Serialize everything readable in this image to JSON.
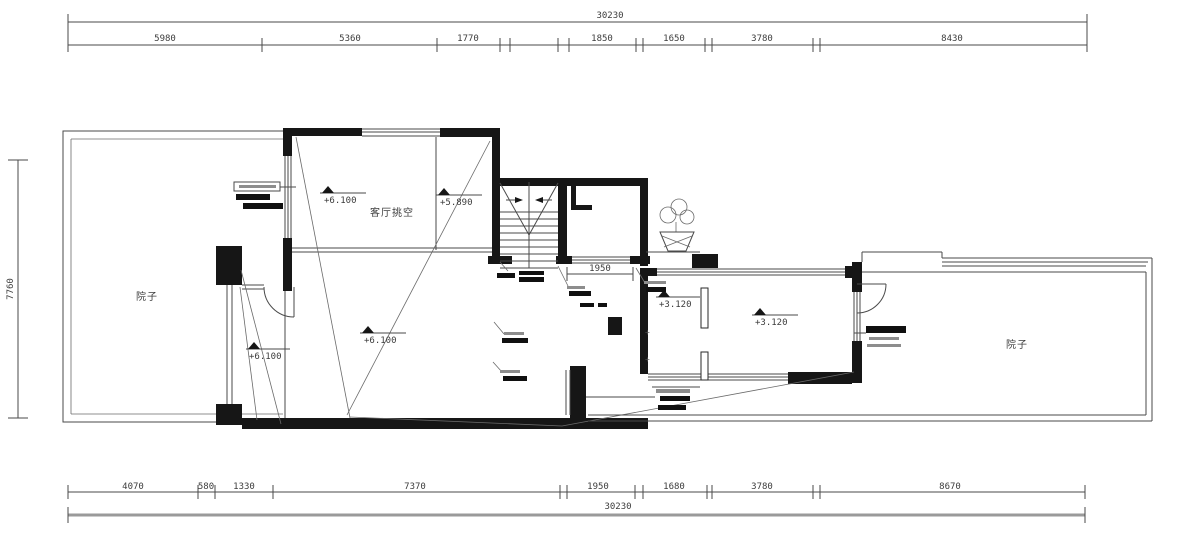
{
  "drawing": {
    "rooms": {
      "living_void": "客厅挑空",
      "courtyard_left": "院子",
      "courtyard_right": "院子"
    },
    "elevations": {
      "e1": "+6.100",
      "e2": "+5.890",
      "e3": "+6.100",
      "e4": "+6.100",
      "e5": "+3.120",
      "e6": "+3.120"
    },
    "dimensions": {
      "overall_top": "30230",
      "overall_bottom": "30230",
      "overall_left": "7760",
      "interior": "1950",
      "top_chain": [
        "5980",
        "5360",
        "1770",
        "1850",
        "1650",
        "3780",
        "8430"
      ],
      "bottom_chain": [
        "4070",
        "580",
        "1330",
        "7370",
        "1950",
        "1680",
        "3780",
        "8670"
      ]
    },
    "colors": {
      "wall": "#161616",
      "line": "#4a4a4a",
      "baseline": "#9a9a9a"
    }
  }
}
